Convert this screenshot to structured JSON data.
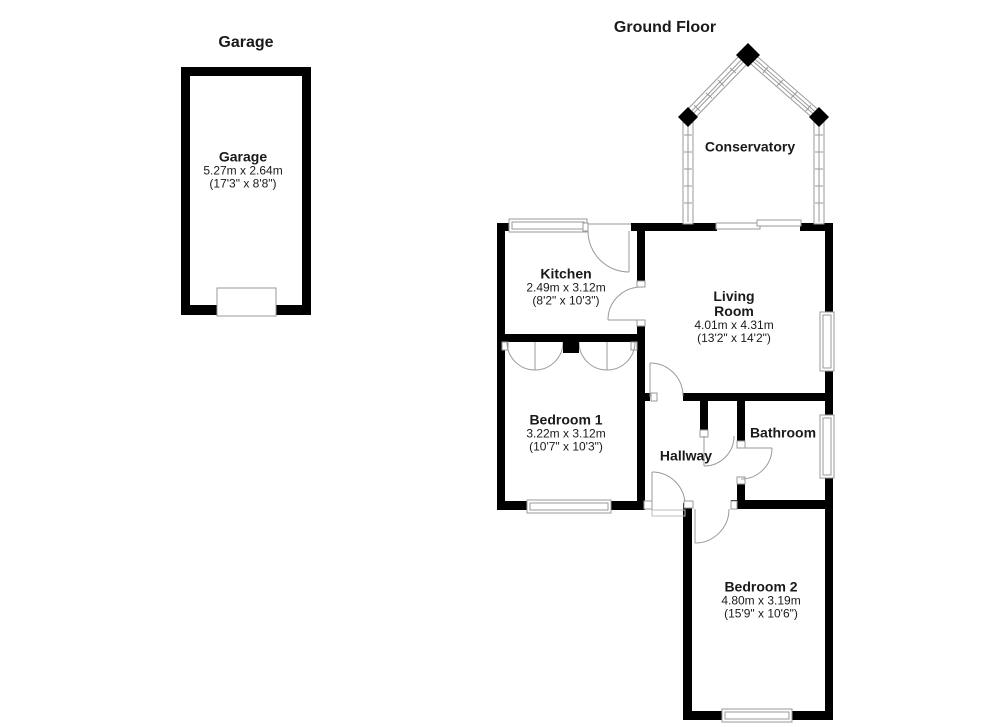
{
  "colors": {
    "wall": "#000000",
    "detail_line": "#9a9a9a",
    "background": "#ffffff"
  },
  "titles": {
    "garage": "Garage",
    "ground_floor": "Ground Floor"
  },
  "rooms": {
    "garage": {
      "name": "Garage",
      "metric": "5.27m x 2.64m",
      "imperial": "(17'3\" x 8'8\")"
    },
    "conservatory": {
      "name": "Conservatory"
    },
    "kitchen": {
      "name": "Kitchen",
      "metric": "2.49m x 3.12m",
      "imperial": "(8'2\" x 10'3\")"
    },
    "living_room": {
      "name_line1": "Living",
      "name_line2": "Room",
      "metric": "4.01m x 4.31m",
      "imperial": "(13'2\" x 14'2\")"
    },
    "bedroom1": {
      "name": "Bedroom 1",
      "metric": "3.22m x 3.12m",
      "imperial": "(10'7\" x 10'3\")"
    },
    "hallway": {
      "name": "Hallway"
    },
    "bathroom": {
      "name": "Bathroom"
    },
    "bedroom2": {
      "name": "Bedroom 2",
      "metric": "4.80m x 3.19m",
      "imperial": "(15'9\" x 10'6\")"
    }
  }
}
